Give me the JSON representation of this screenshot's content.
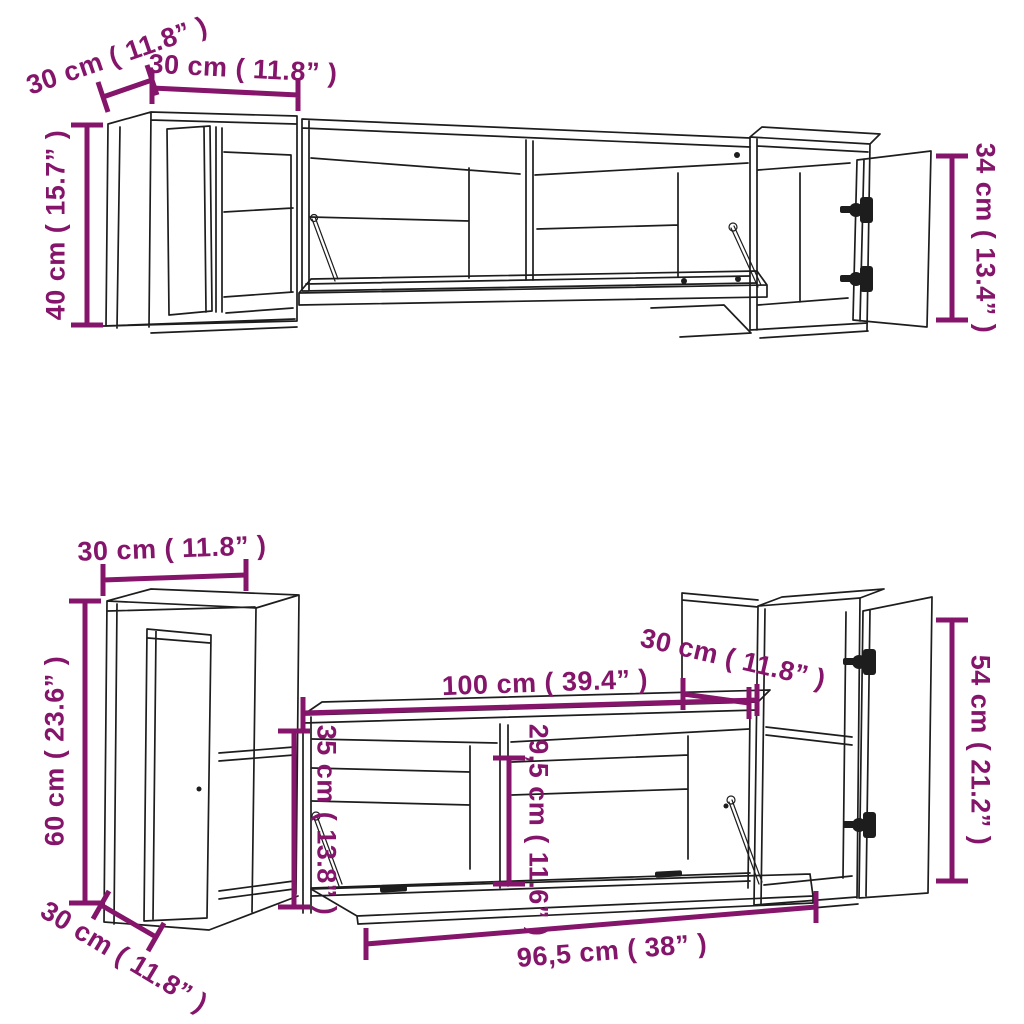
{
  "colors": {
    "dimension_magenta": "#84156A",
    "line_dark": "#1D1D1D",
    "background": "#FFFFFF"
  },
  "top_view": {
    "labels": {
      "depth_left_cabinet": "30 cm ( 11.8” )",
      "width_left_cabinet": "30 cm ( 11.8” )",
      "height_left_cabinet": "40 cm ( 15.7” )",
      "height_right_cabinet": "34 cm ( 13.4” )"
    }
  },
  "bottom_view": {
    "labels": {
      "width_left_cabinet": "30 cm ( 11.8” )",
      "height_left_cabinet": "60 cm ( 23.6” )",
      "depth_left_cabinet": "30 cm ( 11.8” )",
      "width_tv_unit": "100 cm ( 39.4” )",
      "depth_right_cabinet": "30 cm ( 11.8” )",
      "height_right_cabinet": "54 cm ( 21.2” )",
      "height_tv_unit": "35 cm ( 13.8” )",
      "inner_height_tv_unit": "29,5 cm ( 11.6” )",
      "width_flap_door": "96,5 cm ( 38” )"
    }
  }
}
